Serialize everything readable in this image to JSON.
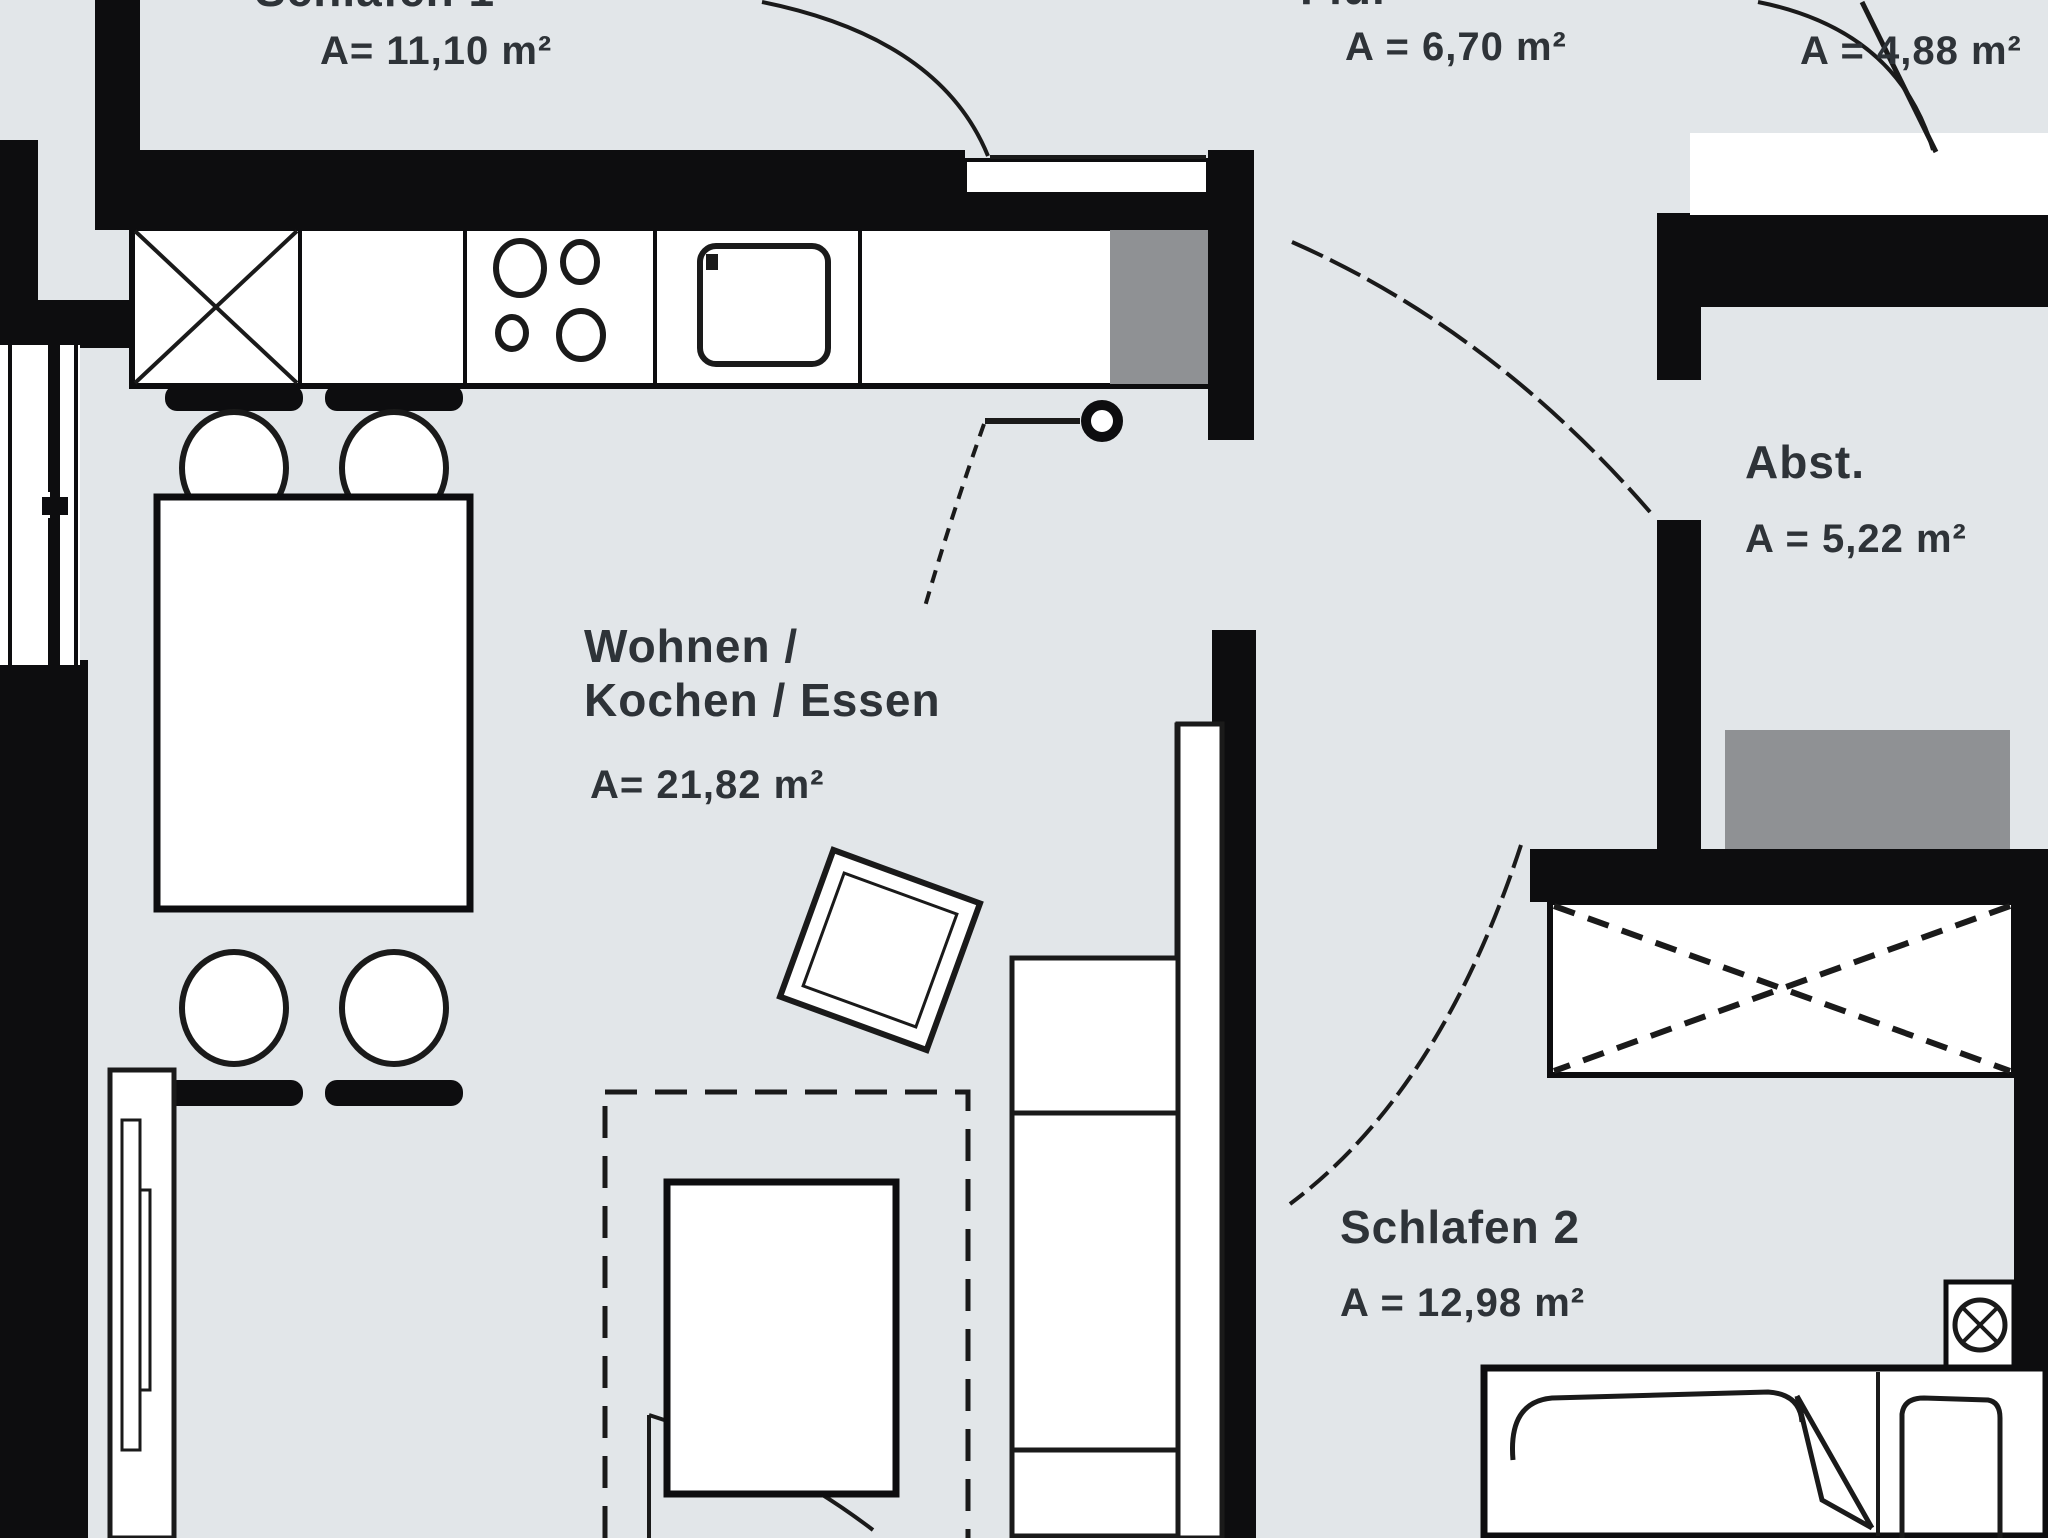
{
  "title": "Apartment floor plan (Grundriss)",
  "labels": {
    "room1_name_partial": "Schlafen 1",
    "room1_area": "A= 11,10 m²",
    "corridor_name_partial": "Flur",
    "corridor_area": "A = 6,70 m²",
    "room_topright_area": "A = 4,88 m²",
    "storage_name": "Abst.",
    "storage_area": "A = 5,22 m²",
    "living_name_line1": "Wohnen /",
    "living_name_line2": "Kochen / Essen",
    "living_area": "A= 21,82 m²",
    "bedroom2_name": "Schlafen 2",
    "bedroom2_area": "A = 12,98 m²"
  },
  "colors": {
    "floor": "#e2e6e9",
    "wall": "#0d0d0f",
    "furniture": "#ffffff",
    "gray": "#8f9194",
    "text": "#2e3338",
    "line": "#1a1a1a"
  },
  "icons": [
    "window-icon",
    "stove-icon",
    "sink-icon",
    "crossed-unit-icon",
    "wardrobe-icon",
    "door-arc-icon",
    "door-hinge-icon",
    "switch-symbol-icon"
  ]
}
